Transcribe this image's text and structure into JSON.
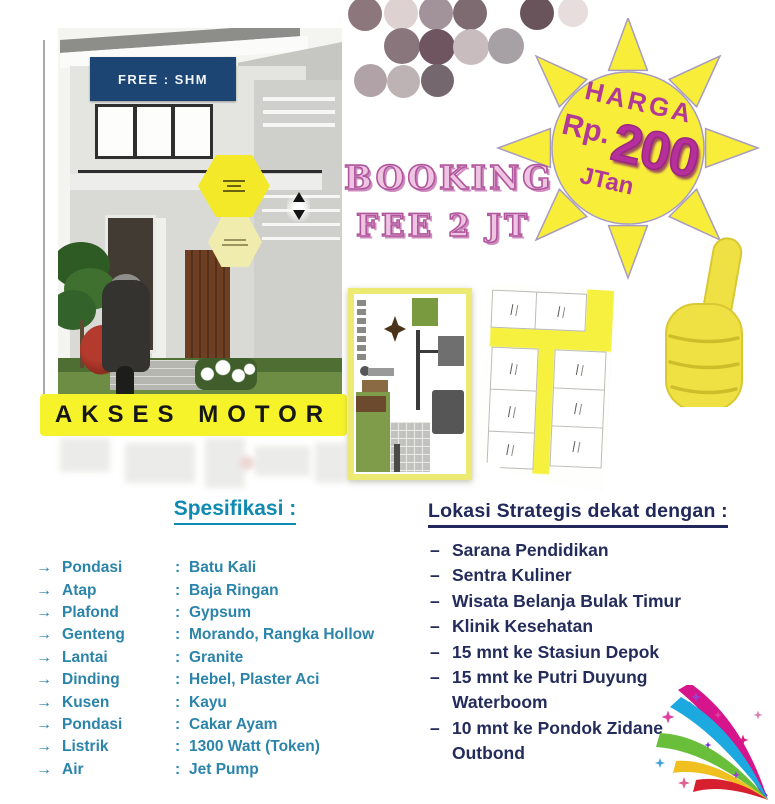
{
  "colors": {
    "sun_yellow": "#f8ee39",
    "sun_outline": "#a79cc0",
    "magenta": "#b23a96",
    "booking_pink": "#d783bd",
    "navy_banner": "#1c4574",
    "akses_yellow": "#f7f32a",
    "spec_teal": "#2b84a9",
    "location_navy": "#232c5b",
    "thumb_yellow": "#efe143"
  },
  "house": {
    "free_banner": "FREE : SHM",
    "akses_banner": "AKSES MOTOR"
  },
  "sun": {
    "title": "HARGA",
    "currency": "Rp.",
    "amount": "200",
    "unit": "JTan"
  },
  "booking": {
    "line1": "BOOKING",
    "line2": "FEE 2 JT"
  },
  "spec": {
    "heading": "Spesifikasi :",
    "bullet": "→",
    "separator": ":",
    "items": [
      {
        "label": "Pondasi",
        "value": "Batu Kali"
      },
      {
        "label": "Atap",
        "value": "Baja Ringan"
      },
      {
        "label": "Plafond",
        "value": "Gypsum"
      },
      {
        "label": "Genteng",
        "value": "Morando, Rangka Hollow"
      },
      {
        "label": "Lantai",
        "value": "Granite"
      },
      {
        "label": "Dinding",
        "value": "Hebel, Plaster Aci"
      },
      {
        "label": "Kusen",
        "value": "Kayu"
      },
      {
        "label": "Pondasi",
        "value": "Cakar Ayam"
      },
      {
        "label": "Listrik",
        "value": "1300 Watt (Token)"
      },
      {
        "label": "Air",
        "value": "Jet Pump"
      }
    ]
  },
  "location": {
    "heading": "Lokasi Strategis dekat dengan :",
    "bullet": "–",
    "items": [
      "Sarana Pendidikan",
      "Sentra Kuliner",
      "Wisata Belanja Bulak Timur",
      "Klinik Kesehatan",
      "15 mnt ke Stasiun Depok",
      "15 mnt ke Putri Duyung Waterboom",
      "10 mnt ke Pondok Zidane Outbond"
    ]
  },
  "dots": [
    {
      "x": 348,
      "y": -3,
      "d": 34,
      "c": "#8c777d"
    },
    {
      "x": 384,
      "y": -4,
      "d": 34,
      "c": "#ddd1d1"
    },
    {
      "x": 419,
      "y": -4,
      "d": 34,
      "c": "#a2939a"
    },
    {
      "x": 453,
      "y": -4,
      "d": 34,
      "c": "#7e6a71"
    },
    {
      "x": 520,
      "y": -4,
      "d": 34,
      "c": "#6a545c"
    },
    {
      "x": 558,
      "y": -3,
      "d": 30,
      "c": "#e7dddd"
    },
    {
      "x": 384,
      "y": 28,
      "d": 36,
      "c": "#89757c"
    },
    {
      "x": 419,
      "y": 29,
      "d": 36,
      "c": "#6e5560"
    },
    {
      "x": 453,
      "y": 29,
      "d": 36,
      "c": "#c9bcbf"
    },
    {
      "x": 488,
      "y": 28,
      "d": 36,
      "c": "#a7a0a4"
    },
    {
      "x": 354,
      "y": 64,
      "d": 33,
      "c": "#b1a2a7"
    },
    {
      "x": 387,
      "y": 65,
      "d": 33,
      "c": "#bdb3b5"
    },
    {
      "x": 421,
      "y": 64,
      "d": 33,
      "c": "#74686e"
    }
  ]
}
